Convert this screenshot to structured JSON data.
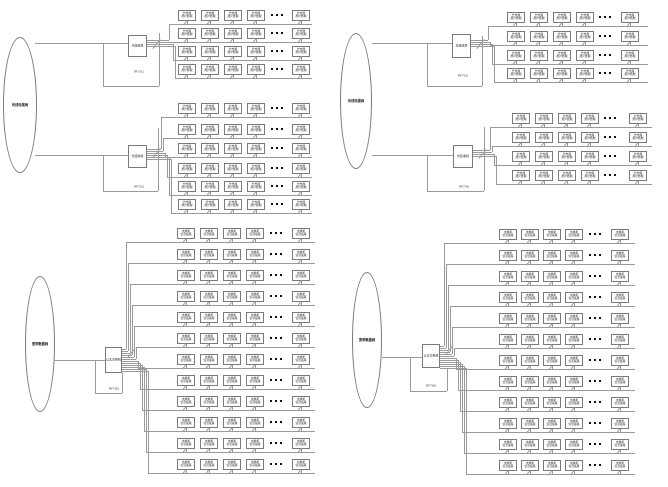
{
  "palette": {
    "background": "#ffffff",
    "wire": "#9a9a9a",
    "node_border": "#7a7a7a",
    "text": "#141414",
    "dots": "#111111"
  },
  "terminal_box": {
    "w": 18,
    "h": 11
  },
  "diagrams": [
    {
      "id": "catv-upper-left",
      "cloud": {
        "label": "有线电视网",
        "x": 3,
        "y": 37,
        "w": 34,
        "h": 136
      },
      "feeds": [
        [
          35,
          43,
          128
        ],
        [
          35,
          155,
          128
        ]
      ],
      "groups": [
        {
          "switch": {
            "label": "光接收机",
            "x": 128,
            "y": 35,
            "w": 19,
            "h": 22
          },
          "cable_label": {
            "text": "RF7(1)",
            "x": 125,
            "y": 68,
            "w": 28
          },
          "loop": {
            "v1": [
              103,
              43,
              86
            ],
            "h": [
              86,
              103,
              159
            ],
            "v2": [
              159,
              33,
              86
            ]
          },
          "fan": {
            "ox": 147,
            "oy": 40,
            "dy": 2,
            "vx": 169,
            "dx": 2
          },
          "rows": {
            "count": 4,
            "left": 178,
            "pitch": 23,
            "tops": [
              10,
              28,
              46,
              64
            ],
            "dots_cx": 277,
            "final_left": 292,
            "right": 312
          },
          "box": {
            "l1": "分支器",
            "l2": "用户终端"
          }
        },
        {
          "switch": {
            "label": "光接收机",
            "x": 128,
            "y": 145,
            "w": 19,
            "h": 23
          },
          "cable_label": {
            "text": "RF7(2)",
            "x": 125,
            "y": 183,
            "w": 28
          },
          "loop": {
            "v1": [
              103,
              155,
              191
            ],
            "h": [
              191,
              103,
              158
            ],
            "v2": [
              158,
              128,
              191
            ]
          },
          "fan": {
            "ox": 147,
            "oy": 149,
            "dy": 2,
            "vx": 161,
            "dx": 2
          },
          "rows": {
            "count": 6,
            "left": 178,
            "pitch": 23,
            "tops": [
              103,
              124,
              143,
              163,
              181,
              199
            ],
            "dots_cx": 277,
            "final_left": 292,
            "right": 312
          },
          "box": {
            "l1": "分支器",
            "l2": "用户终端"
          }
        }
      ]
    },
    {
      "id": "catv-upper-right",
      "cloud": {
        "label": "有线电视网",
        "x": 340,
        "y": 33,
        "w": 32,
        "h": 136
      },
      "feeds": [
        [
          372,
          43,
          452
        ],
        [
          372,
          155,
          453
        ]
      ],
      "groups": [
        {
          "switch": {
            "label": "光接收机",
            "x": 452,
            "y": 34,
            "w": 19,
            "h": 24
          },
          "cable_label": {
            "text": "RF7(3)",
            "x": 449,
            "y": 72,
            "w": 28
          },
          "loop": {
            "v1": [
              427,
              43,
              86
            ],
            "h": [
              86,
              427,
              482
            ],
            "v2": [
              482,
              36,
              86
            ]
          },
          "fan": {
            "ox": 471,
            "oy": 40,
            "dy": 2,
            "vx": 488,
            "dx": 2
          },
          "rows": {
            "count": 4,
            "left": 507,
            "pitch": 23,
            "tops": [
              12,
              31,
              50,
              68
            ],
            "dots_cx": 605,
            "final_left": 621,
            "right": 648
          },
          "box": {
            "l1": "分支器",
            "l2": "用户终端"
          }
        },
        {
          "switch": {
            "label": "光接收机",
            "x": 453,
            "y": 145,
            "w": 20,
            "h": 23
          },
          "cable_label": {
            "text": "RF7(4)",
            "x": 450,
            "y": 183,
            "w": 28
          },
          "loop": {
            "v1": [
              427,
              155,
              191
            ],
            "h": [
              191,
              427,
              484
            ],
            "v2": [
              484,
              127,
              191
            ]
          },
          "fan": {
            "ox": 473,
            "oy": 150,
            "dy": 2,
            "vx": 490,
            "dx": 2
          },
          "rows": {
            "count": 4,
            "left": 512,
            "pitch": 23,
            "tops": [
              113,
              132,
              151,
              170
            ],
            "dots_cx": 610,
            "final_left": 629,
            "right": 652
          },
          "box": {
            "l1": "分支器",
            "l2": "用户终端"
          }
        }
      ]
    },
    {
      "id": "data-lower-left",
      "cloud": {
        "label": "宽带数据网",
        "x": 25,
        "y": 276,
        "w": 30,
        "h": 136
      },
      "feeds": [
        [
          54,
          360,
          105
        ]
      ],
      "groups": [
        {
          "switch": {
            "label": "以太交换机",
            "x": 105,
            "y": 347,
            "w": 17,
            "h": 26
          },
          "cable_label": {
            "text": "RF7(5)",
            "x": 101,
            "y": 385,
            "w": 26
          },
          "loop": {
            "v1": [
              95,
              360,
              393
            ],
            "h": [
              393,
              95,
              122
            ],
            "v2": [
              122,
              373,
              393
            ]
          },
          "fan": {
            "ox": 122,
            "oy": 349,
            "dy": 2,
            "vx": 126,
            "dx": 2
          },
          "rows": {
            "count": 12,
            "left": 177,
            "pitch": 23,
            "tops": [
              228,
              249,
              270,
              291,
              312,
              333,
              354,
              375,
              396,
              417,
              438,
              459
            ],
            "dots_cx": 276,
            "final_left": 292,
            "right": 315
          },
          "box": {
            "l1": "交换机",
            "l2": "信息插座"
          }
        }
      ]
    },
    {
      "id": "data-lower-right",
      "cloud": {
        "label": "宽带数据网",
        "x": 352,
        "y": 272,
        "w": 30,
        "h": 136
      },
      "feeds": [
        [
          382,
          357,
          422
        ]
      ],
      "groups": [
        {
          "switch": {
            "label": "以太交换机",
            "x": 422,
            "y": 344,
            "w": 18,
            "h": 24
          },
          "cable_label": {
            "text": "RF7(6)",
            "x": 418,
            "y": 382,
            "w": 26
          },
          "loop": {
            "v1": [
              410,
              357,
              391
            ],
            "h": [
              391,
              410,
              447
            ],
            "v2": [
              447,
              368,
              391
            ]
          },
          "fan": {
            "ox": 440,
            "oy": 346,
            "dy": 2,
            "vx": 444,
            "dx": 2
          },
          "rows": {
            "count": 12,
            "left": 499,
            "pitch": 22,
            "tops": [
              229,
              250,
              271,
              292,
              313,
              334,
              355,
              376,
              397,
              418,
              439,
              460
            ],
            "dots_cx": 595,
            "final_left": 611,
            "right": 635
          },
          "box": {
            "l1": "交换机",
            "l2": "信息插座"
          }
        }
      ]
    }
  ]
}
